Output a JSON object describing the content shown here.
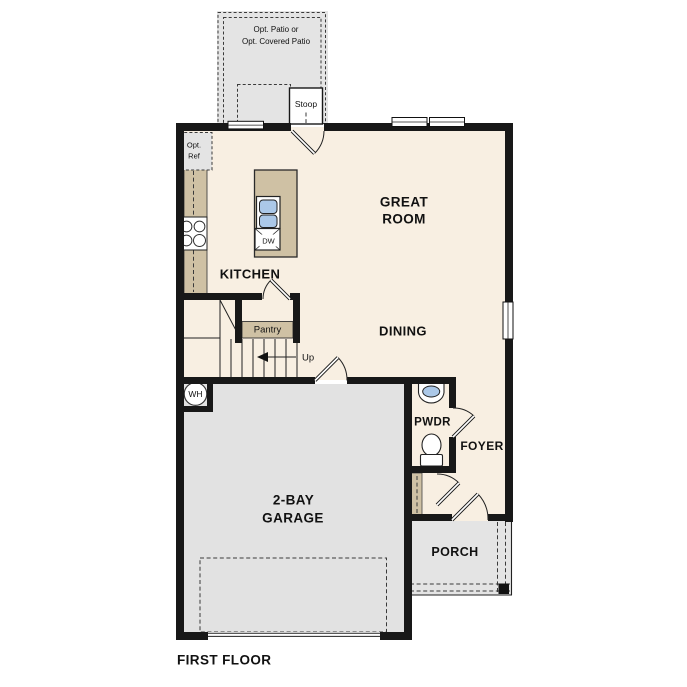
{
  "plan": {
    "labels": {
      "patio1": "Opt. Patio or",
      "patio2": "Opt. Covered Patio",
      "stoop": "Stoop",
      "opt_ref1": "Opt.",
      "opt_ref2": "Ref",
      "kitchen": "KITCHEN",
      "great1": "GREAT",
      "great2": "ROOM",
      "dining": "DINING",
      "pantry": "Pantry",
      "up": "Up",
      "dw": "DW",
      "wh": "WH",
      "pwdr": "PWDR",
      "foyer": "FOYER",
      "garage1": "2-BAY",
      "garage2": "GARAGE",
      "porch": "PORCH",
      "first_floor": "FIRST FLOOR"
    },
    "colors": {
      "floor": "#f8efe2",
      "concrete": "#e4e4e4",
      "garage": "#e2e2e2",
      "counter": "#cfc1a4",
      "sink": "#abc8e8",
      "wall": "#181818",
      "text": "#111111"
    }
  }
}
